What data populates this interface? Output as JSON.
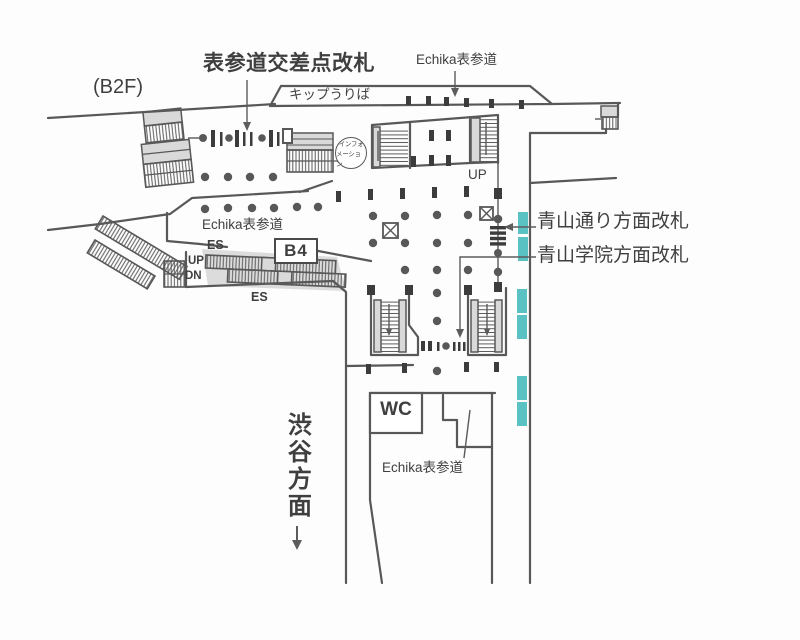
{
  "map": {
    "floor": "(B2F)",
    "labels": {
      "gate_main": "表参道交差点改札",
      "echika_top": "Echika表参道",
      "ticket_office": "キップうりば",
      "info_1": "インフォ",
      "info_2": "メーション",
      "up_center": "UP",
      "echika_left": "Echika表参道",
      "es_upper": "ES",
      "b4": "B4",
      "up_left": "UP",
      "dn_left": "DN",
      "es_lower": "ES",
      "gate_aoyama_dori": "青山通り方面改札",
      "gate_aoyama_gakuin": "青山学院方面改札",
      "wc": "WC",
      "echika_lower": "Echika表参道",
      "shibuya": "渋谷方面"
    },
    "colors": {
      "wall": "#585858",
      "ink": "#3f3f3f",
      "teal": "#5bc2c4",
      "fill": "#d9d9d9",
      "blk": "#3c3c3c"
    }
  }
}
